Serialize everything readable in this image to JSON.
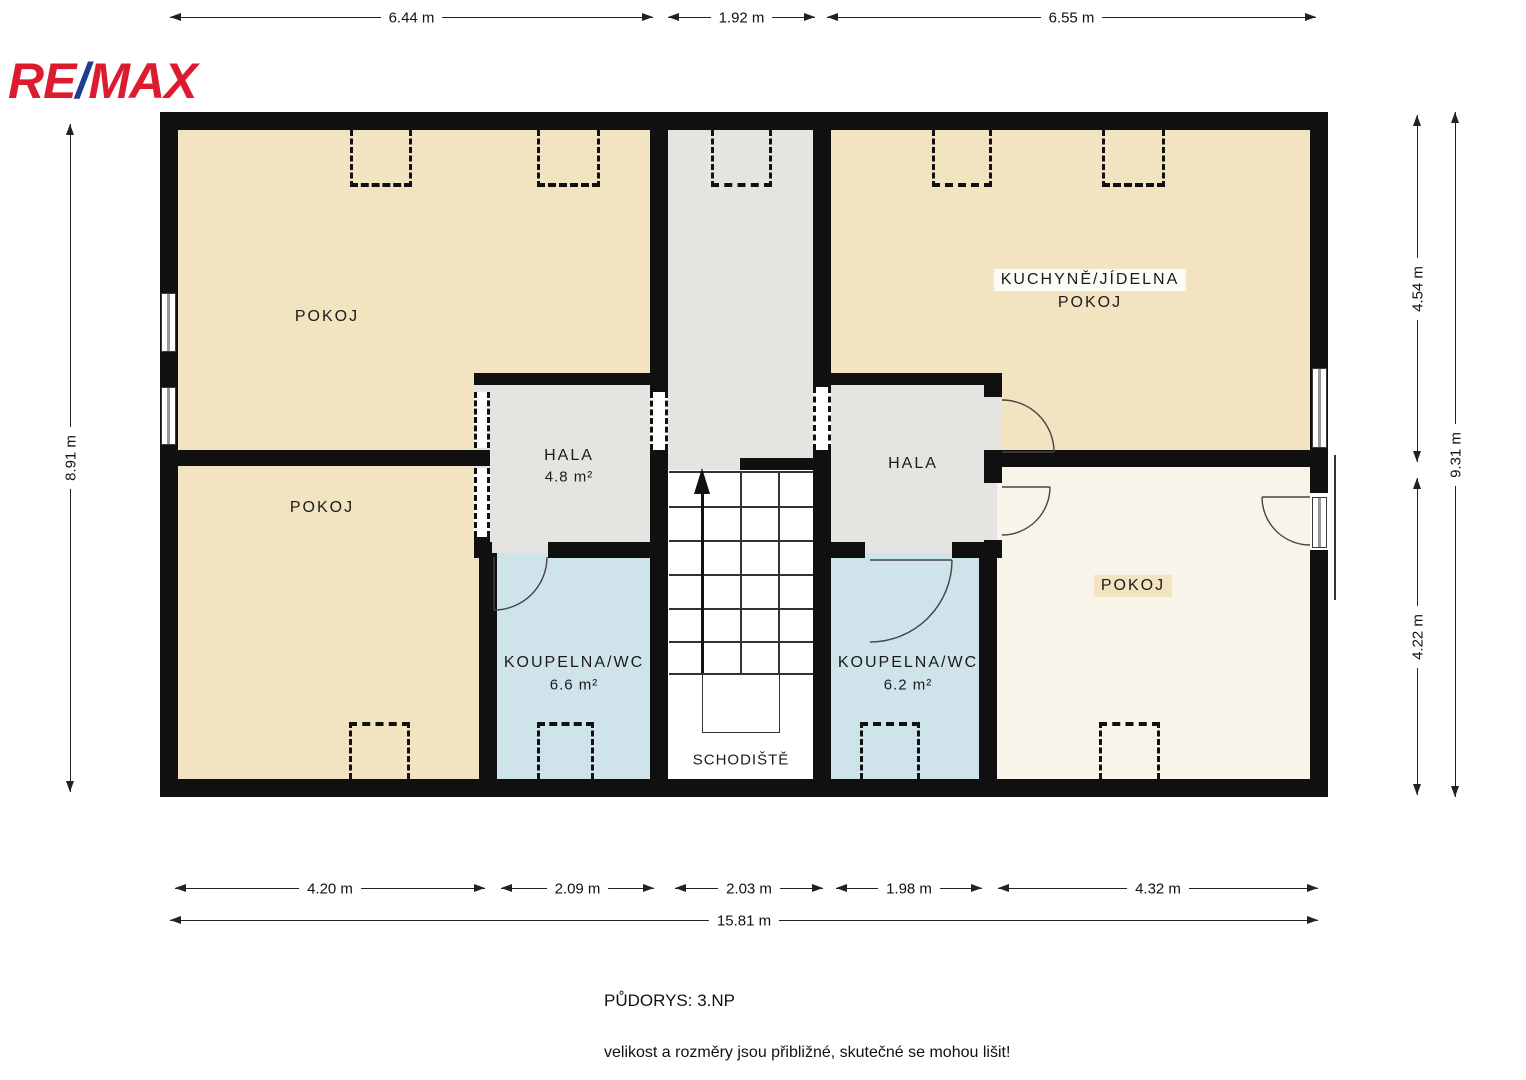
{
  "logo": {
    "re": "RE",
    "slash": "/",
    "max": "MAX"
  },
  "rooms": {
    "pokoj_top_left": "POKOJ",
    "pokoj_bottom_left": "POKOJ",
    "kitchen_line1": "KUCHYNĚ/JÍDELNA",
    "kitchen_line2": "POKOJ",
    "hala_left": {
      "name": "HALA",
      "area": "4.8 m²"
    },
    "hala_right": "HALA",
    "koupelna_left": {
      "name": "KOUPELNA/WC",
      "area": "6.6 m²"
    },
    "koupelna_right": {
      "name": "KOUPELNA/WC",
      "area": "6.2 m²"
    },
    "schodiste": "SCHODIŠTĚ",
    "pokoj_bottom_right": "POKOJ"
  },
  "dimensions": {
    "top": [
      "6.44 m",
      "1.92 m",
      "6.55 m"
    ],
    "bottom": [
      "4.20 m",
      "2.09 m",
      "2.03 m",
      "1.98 m",
      "4.32 m"
    ],
    "bottom_total": "15.81 m",
    "left": "8.91 m",
    "right": [
      "4.54 m",
      "4.22 m"
    ],
    "right_total": "9.31 m"
  },
  "footer": {
    "title": "PŮDORYS: 3.NP",
    "disclaimer": "velikost a rozměry jsou přibližné, skutečné se mohou lišit!"
  },
  "colors": {
    "brand_red": "#dc1c2e",
    "brand_blue": "#1c3f94",
    "room_beige": "#f2e3c1",
    "room_gray": "#e4e4e1",
    "room_blue": "#cfe3ea",
    "room_cream": "#f8f4ea",
    "wall_black": "#101010"
  }
}
